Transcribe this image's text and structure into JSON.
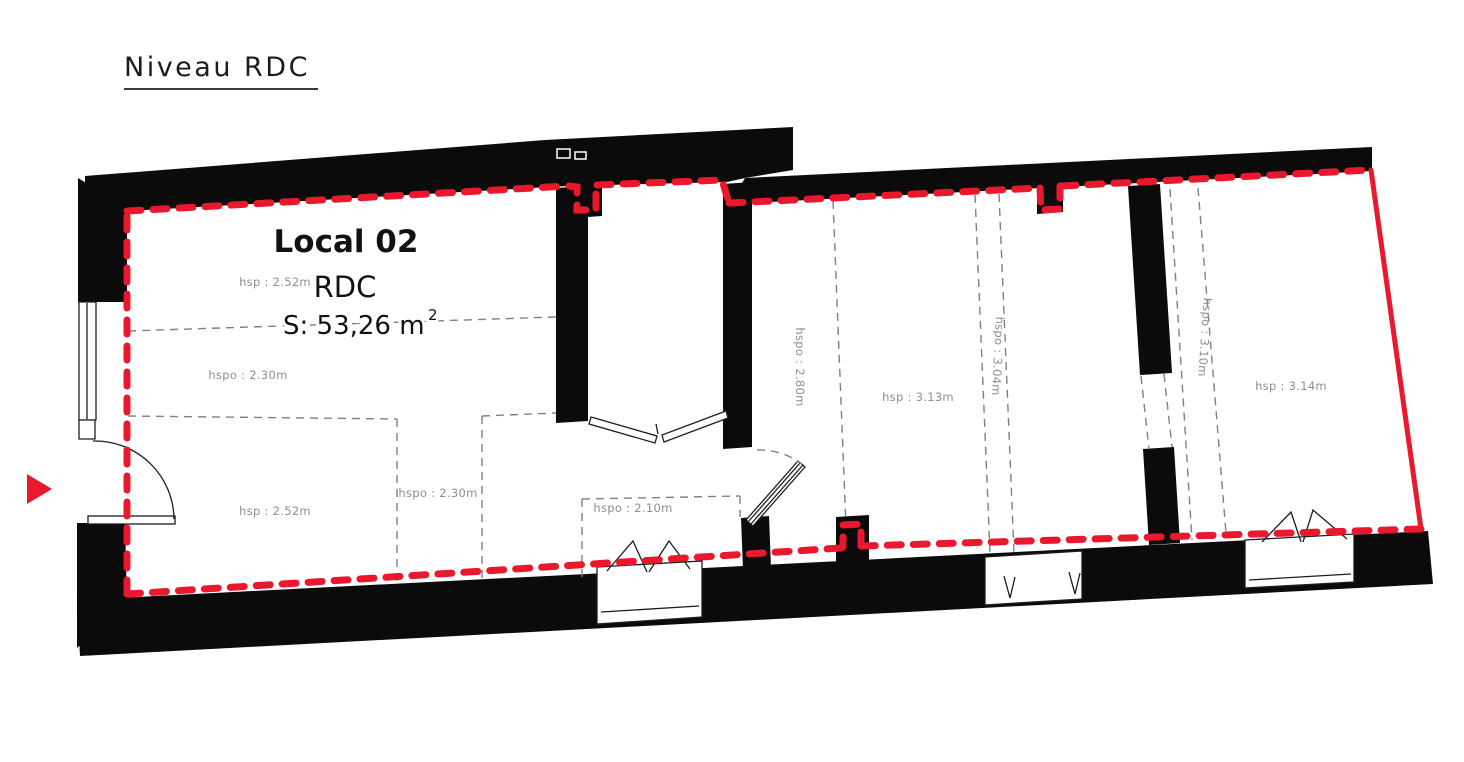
{
  "title": "Niveau RDC",
  "local": {
    "name": "Local 02",
    "level": "RDC",
    "area": "S: 53,26 m",
    "area_sup": "2"
  },
  "labels": {
    "hsp_left_upper": "hsp : 2.52m",
    "hspo_left_upper": "hspo : 2.30m",
    "hsp_left_lower": "hsp : 2.52m",
    "hspo_left_lower": "hspo : 2.30m",
    "hspo_entry": "hspo : 2.10m",
    "hspo_corridor": "hspo : 2.80m",
    "hsp_middle": "hsp : 3.13m",
    "hspo_middle": "hspo : 3.04m",
    "hspo_right": "hspo : 3.10m",
    "hsp_right": "hsp : 3.14m"
  },
  "colors": {
    "boundary_red": "#e9182c",
    "wall_black": "#0b0b0b",
    "hidden_line_gray": "#808080",
    "label_gray": "#8f8f8f",
    "text_dark": "#111111"
  }
}
